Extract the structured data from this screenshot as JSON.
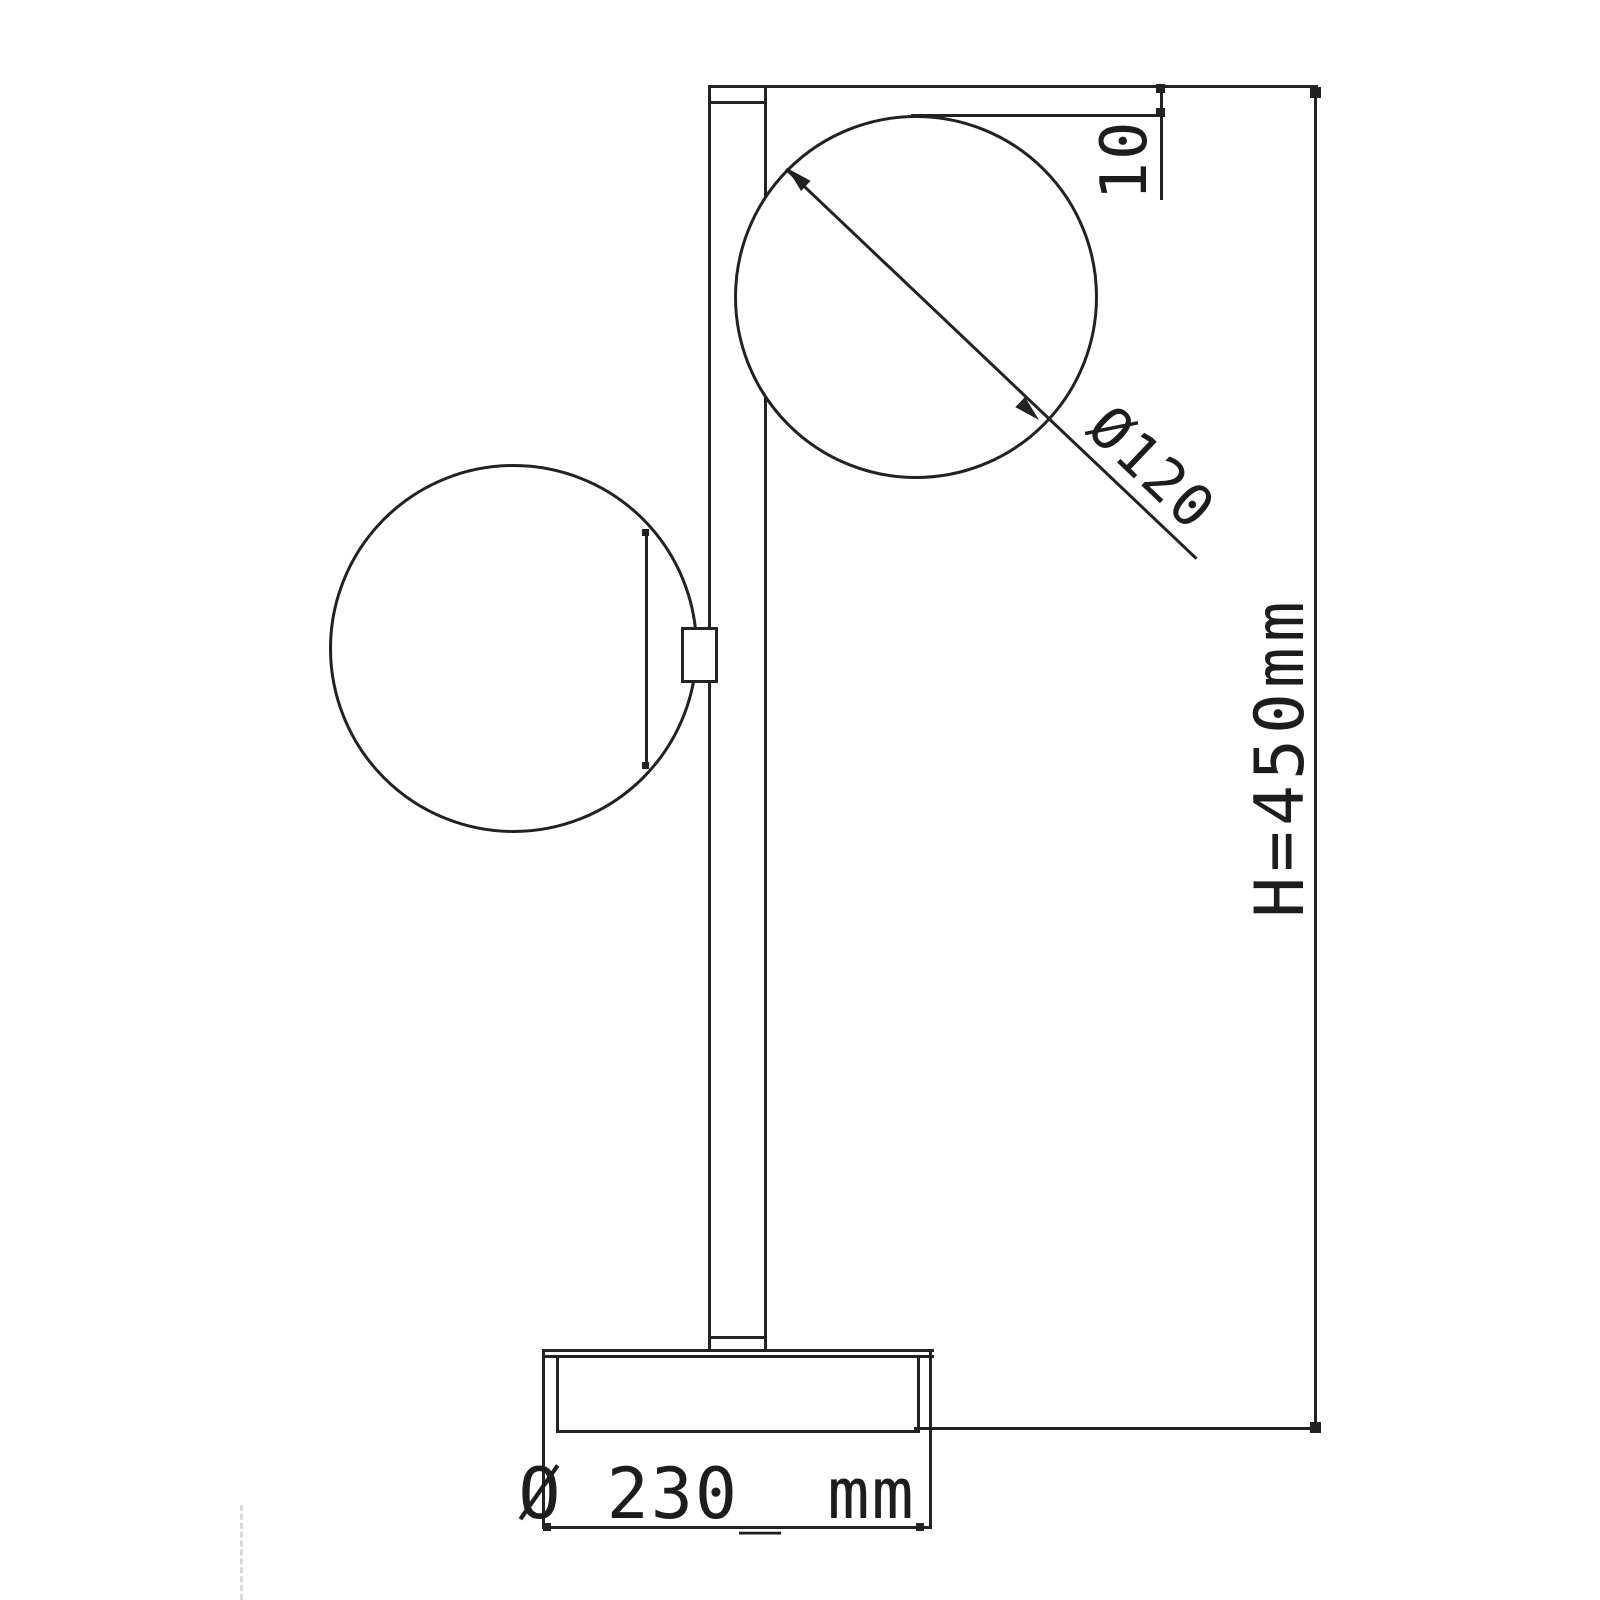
{
  "drawing": {
    "type": "technical-dimension-drawing",
    "subject": "two-globe table lamp, side elevation",
    "background_color": "#ffffff",
    "line_color": "#222222",
    "labels": {
      "top_offset": "10",
      "globe_diameter": "Ø120",
      "overall_height": "H=450mm",
      "base_diameter": "Ø 230_ mm"
    }
  }
}
